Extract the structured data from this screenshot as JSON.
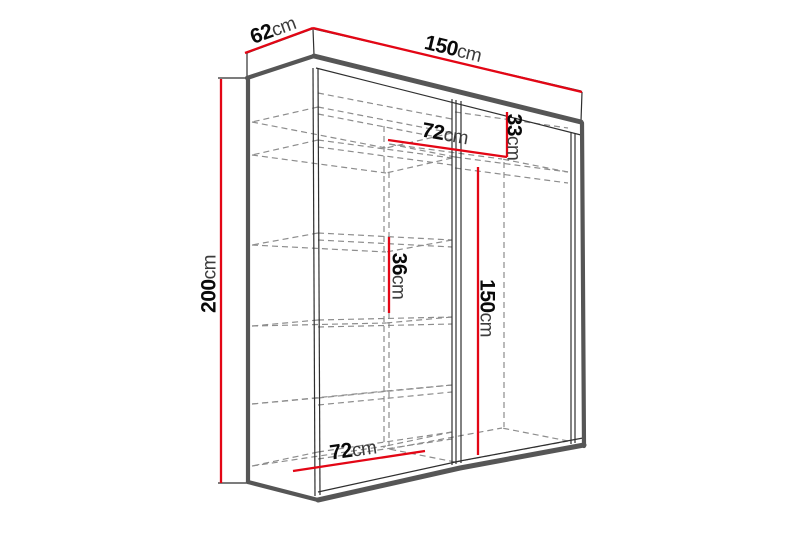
{
  "title": "Wardrobe dimension diagram",
  "colors": {
    "dimension_red": "#e30615",
    "outline_gray": "#565656",
    "hidden_line_gray": "#8d8d8d",
    "label_black": "#0c0c0c",
    "background": "#ffffff"
  },
  "dimensions": {
    "depth": {
      "value": "62",
      "unit": "cm"
    },
    "width": {
      "value": "150",
      "unit": "cm"
    },
    "height": {
      "value": "200",
      "unit": "cm"
    },
    "top_shelf_width": {
      "value": "72",
      "unit": "cm"
    },
    "top_shelf_height": {
      "value": "33",
      "unit": "cm"
    },
    "shelf_spacing": {
      "value": "36",
      "unit": "cm"
    },
    "hanging_space_height": {
      "value": "150",
      "unit": "cm"
    },
    "bottom_shelf_width": {
      "value": "72",
      "unit": "cm"
    }
  }
}
